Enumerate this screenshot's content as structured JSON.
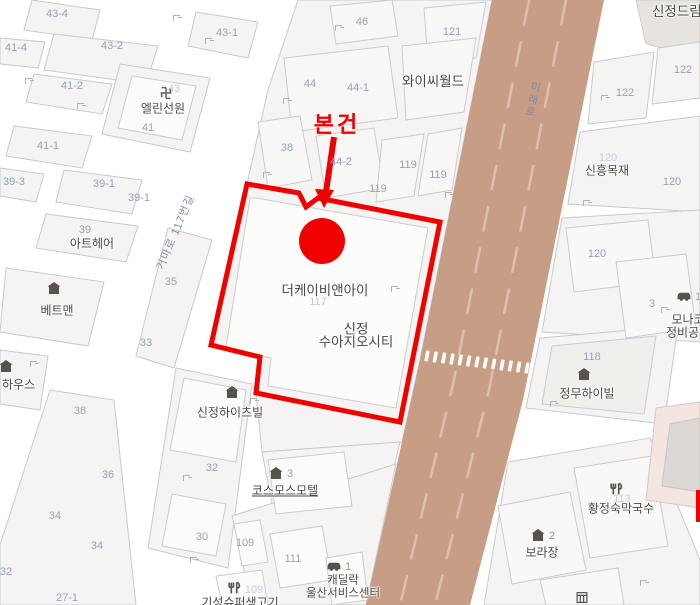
{
  "annotation": {
    "label": "본건",
    "color": "#f10000"
  },
  "roads": {
    "main": "미래로",
    "side": "거마로 117번길"
  },
  "subject": {
    "building": "더케이비앤아이",
    "complex_line1": "신정",
    "complex_line2": "수아지오시티"
  },
  "pois": [
    {
      "name": "엘린선원",
      "icon": "temple"
    },
    {
      "name": "와이씨월드"
    },
    {
      "name": "아트헤어"
    },
    {
      "name": "베트맨",
      "icon": "building"
    },
    {
      "name": "하우스",
      "icon": "building"
    },
    {
      "name": "신정하이츠빌",
      "icon": "building"
    },
    {
      "name": "코스모스모텔",
      "icon": "building",
      "number": "3"
    },
    {
      "name": "신정드림"
    },
    {
      "name": "신흥목재"
    },
    {
      "line1": "모나코",
      "line2": "정비공업",
      "icon": "car",
      "number": "1"
    },
    {
      "name": "정무하이빌",
      "icon": "building"
    },
    {
      "name": "황정숙막국수",
      "icon": "restaurant"
    },
    {
      "name": "보라장",
      "icon": "building",
      "number": "2"
    },
    {
      "line1": "캐딜락",
      "line2": "울산서비스센터",
      "icon": "car",
      "number": "1"
    },
    {
      "name": "기성슈퍼생고기",
      "icon": "restaurant",
      "number": "109"
    }
  ],
  "lots": [
    "43-4",
    "41-4",
    "43-2",
    "43-1",
    "41-2",
    "43",
    "41",
    "41-1",
    "39-3",
    "39-1",
    "39-1",
    "39",
    "35",
    "33",
    "46",
    "121",
    "44",
    "44-1",
    "38",
    "44-2",
    "119",
    "119",
    "119",
    "117",
    "122",
    "122",
    "120",
    "120",
    "120",
    "3",
    "118",
    "113",
    "32",
    "30",
    "38",
    "36",
    "34",
    "34",
    "32",
    "27-1",
    "109",
    "111",
    "109"
  ],
  "icons": {
    "temple": "swastika-manji",
    "building": "dark-house",
    "restaurant": "fork-and-knife",
    "car": "car-silhouette",
    "storage": "hatched-box",
    "entrance": "corner-entrance-mark"
  },
  "colors": {
    "road_fill": "#c89d85",
    "road_dash": "#ddbfae",
    "parcel": "#f5f4f2",
    "parcel_outline": "#c6cad0",
    "building": "#fbfbfa",
    "lot_text": "#94a1bd",
    "poi_text": "#4b4742",
    "annotation_red": "#f10000",
    "dream_block": "#e7e3df",
    "pink_building": "#f3e5e0"
  }
}
